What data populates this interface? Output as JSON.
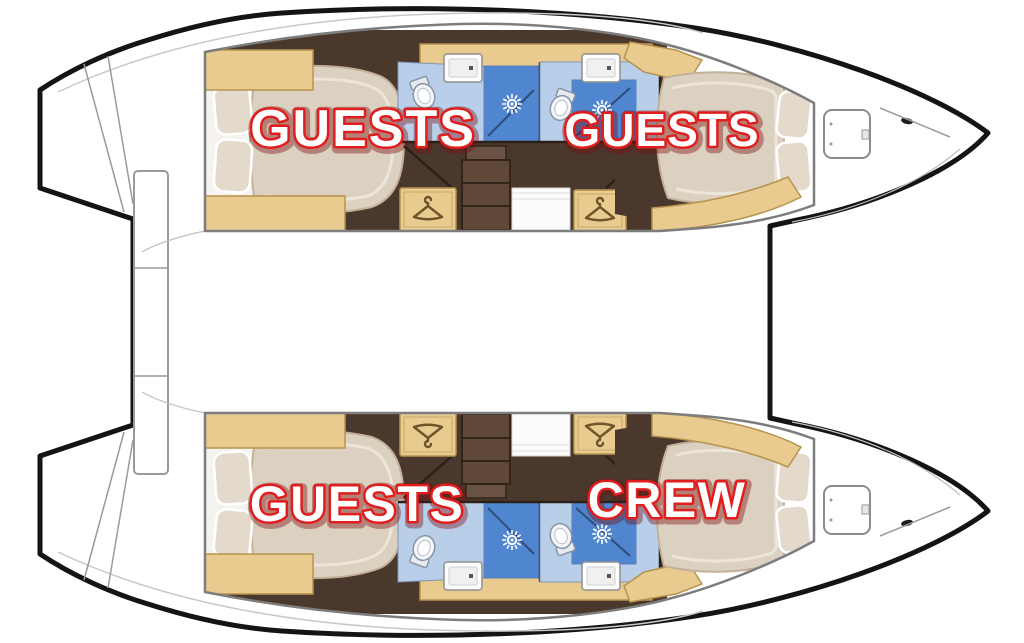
{
  "labels": [
    {
      "id": "port-aft-cabin",
      "text": "GUESTS"
    },
    {
      "id": "port-forward-cabin",
      "text": "GUESTS"
    },
    {
      "id": "starboard-aft-cabin",
      "text": "GUESTS"
    },
    {
      "id": "starboard-forward-cabin",
      "text": "CREW"
    }
  ],
  "icons": [
    "hanger-icon",
    "shower-spray-icon",
    "toilet-icon",
    "sink-icon",
    "deck-hatch-icon",
    "companionway-steps",
    "double-berth",
    "pillow"
  ],
  "colors": {
    "page-bg": "#ffffff",
    "hull-outline": "#141414",
    "line-gray": "#9a9a9a",
    "wood-tan": "#e9cb90",
    "wood-tan-border": "#b6934f",
    "floor-brown": "#4b382c",
    "bath-blue-light": "#b9cfe9",
    "shower-blue": "#4f86cf",
    "bed-beige": "#dcd1c1",
    "pillow": "#e4dacb",
    "label-fill": "#ffffff",
    "label-stroke": "#e11d1d",
    "label-glow": "#7a0c0c"
  }
}
